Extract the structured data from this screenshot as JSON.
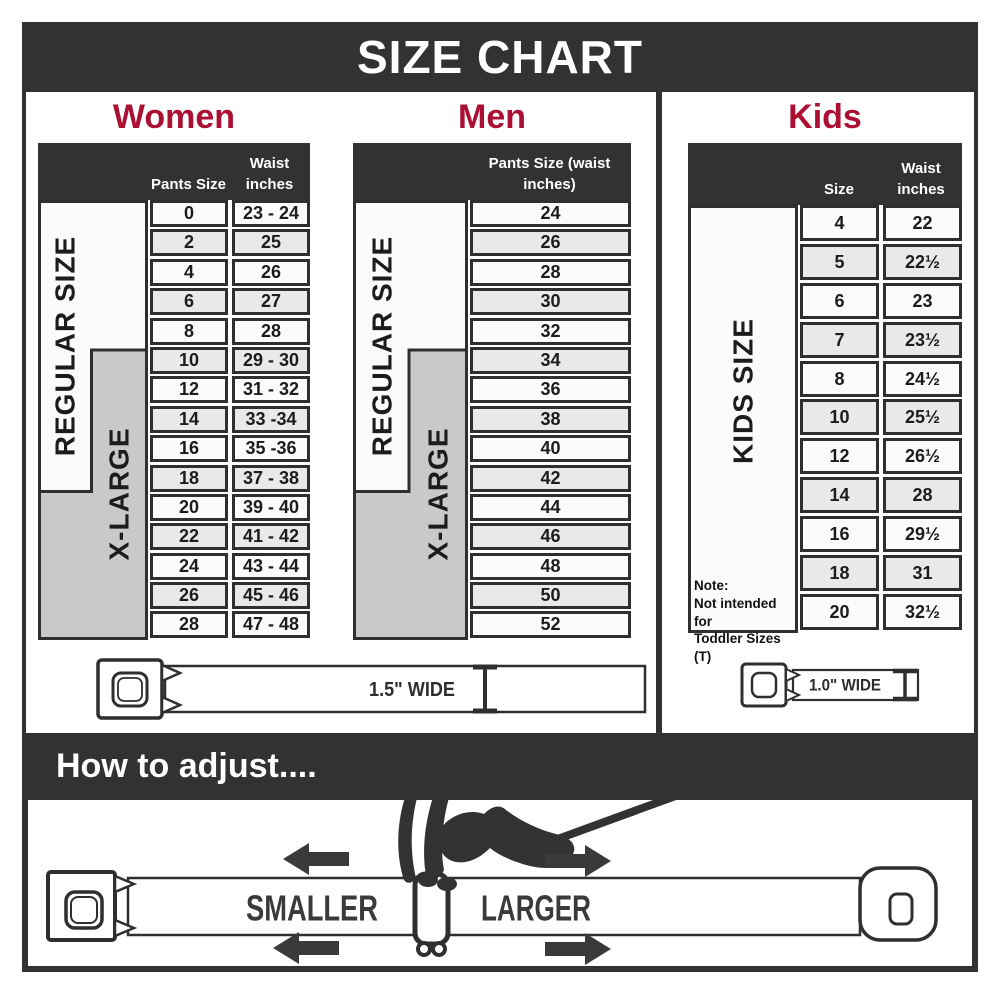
{
  "title": "SIZE CHART",
  "colors": {
    "dark": "#323232",
    "accent_red": "#AB1032",
    "band_gray": "#C9C9C9",
    "row_shade": "#E9E9E9"
  },
  "women": {
    "heading": "Women",
    "col_size": "Pants Size",
    "col_waist": "Waist inches",
    "regular_band": "REGULAR SIZE",
    "xlarge_band": "X-LARGE",
    "rows": [
      [
        "0",
        "23 - 24"
      ],
      [
        "2",
        "25"
      ],
      [
        "4",
        "26"
      ],
      [
        "6",
        "27"
      ],
      [
        "8",
        "28"
      ],
      [
        "10",
        "29 - 30"
      ],
      [
        "12",
        "31 - 32"
      ],
      [
        "14",
        "33 -34"
      ],
      [
        "16",
        "35 -36"
      ],
      [
        "18",
        "37 - 38"
      ],
      [
        "20",
        "39 - 40"
      ],
      [
        "22",
        "41 - 42"
      ],
      [
        "24",
        "43 - 44"
      ],
      [
        "26",
        "45 - 46"
      ],
      [
        "28",
        "47 - 48"
      ]
    ]
  },
  "men": {
    "heading": "Men",
    "col_size": "Pants Size (waist inches)",
    "regular_band": "REGULAR SIZE",
    "xlarge_band": "X-LARGE",
    "rows": [
      [
        "24"
      ],
      [
        "26"
      ],
      [
        "28"
      ],
      [
        "30"
      ],
      [
        "32"
      ],
      [
        "34"
      ],
      [
        "36"
      ],
      [
        "38"
      ],
      [
        "40"
      ],
      [
        "42"
      ],
      [
        "44"
      ],
      [
        "46"
      ],
      [
        "48"
      ],
      [
        "50"
      ],
      [
        "52"
      ]
    ]
  },
  "kids": {
    "heading": "Kids",
    "col_size": "Size",
    "col_waist": "Waist inches",
    "band": "KIDS SIZE",
    "note_line1": "Note:",
    "note_line2": "Not intended for",
    "note_line3": "Toddler Sizes (T)",
    "rows": [
      [
        "4",
        "22"
      ],
      [
        "5",
        "22½"
      ],
      [
        "6",
        "23"
      ],
      [
        "7",
        "23½"
      ],
      [
        "8",
        "24½"
      ],
      [
        "10",
        "25½"
      ],
      [
        "12",
        "26½"
      ],
      [
        "14",
        "28"
      ],
      [
        "16",
        "29½"
      ],
      [
        "18",
        "31"
      ],
      [
        "20",
        "32½"
      ]
    ]
  },
  "belts": {
    "adult_width": "1.5\" WIDE",
    "kids_width": "1.0\" WIDE"
  },
  "adjust": {
    "heading": "How to adjust....",
    "smaller": "SMALLER",
    "larger": "LARGER"
  },
  "icons": {
    "buckle": "seatbelt-buckle-icon",
    "width_marker": "i-beam-width-marker-icon",
    "hand": "pinching-hand-icon",
    "left_arrow": "arrow-left-icon",
    "right_arrow": "arrow-right-icon"
  }
}
